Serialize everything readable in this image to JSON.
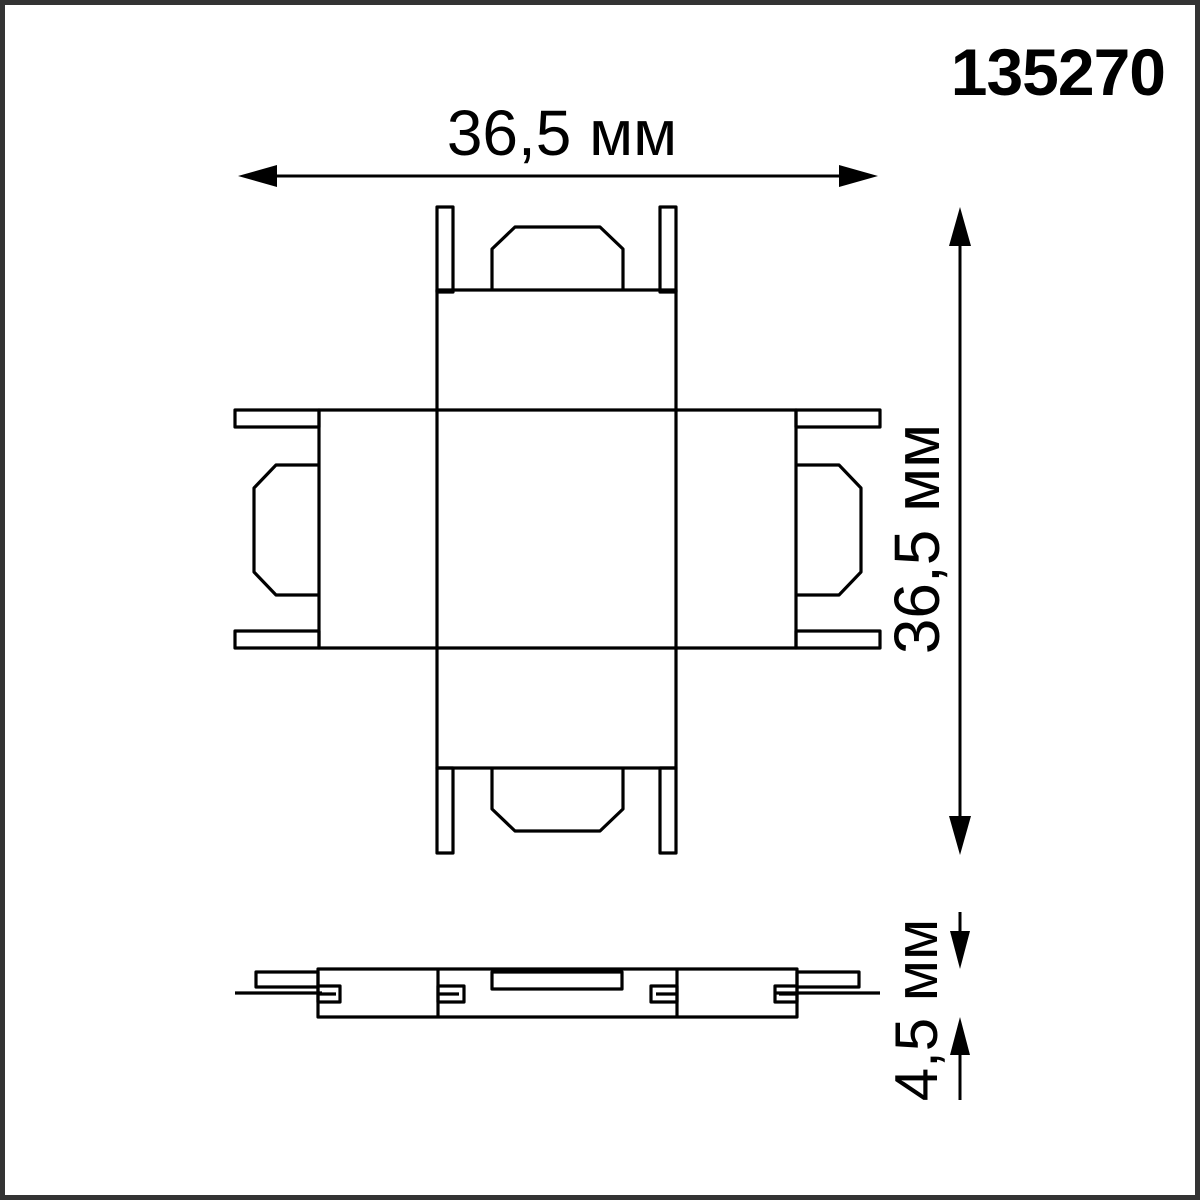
{
  "part_number": "135270",
  "dimensions": {
    "width_label": "36,5 мм",
    "height_label": "36,5 мм",
    "thickness_label": "4,5 мм"
  },
  "colors": {
    "line": "#000000",
    "background": "#ffffff",
    "frame": "#333333"
  }
}
